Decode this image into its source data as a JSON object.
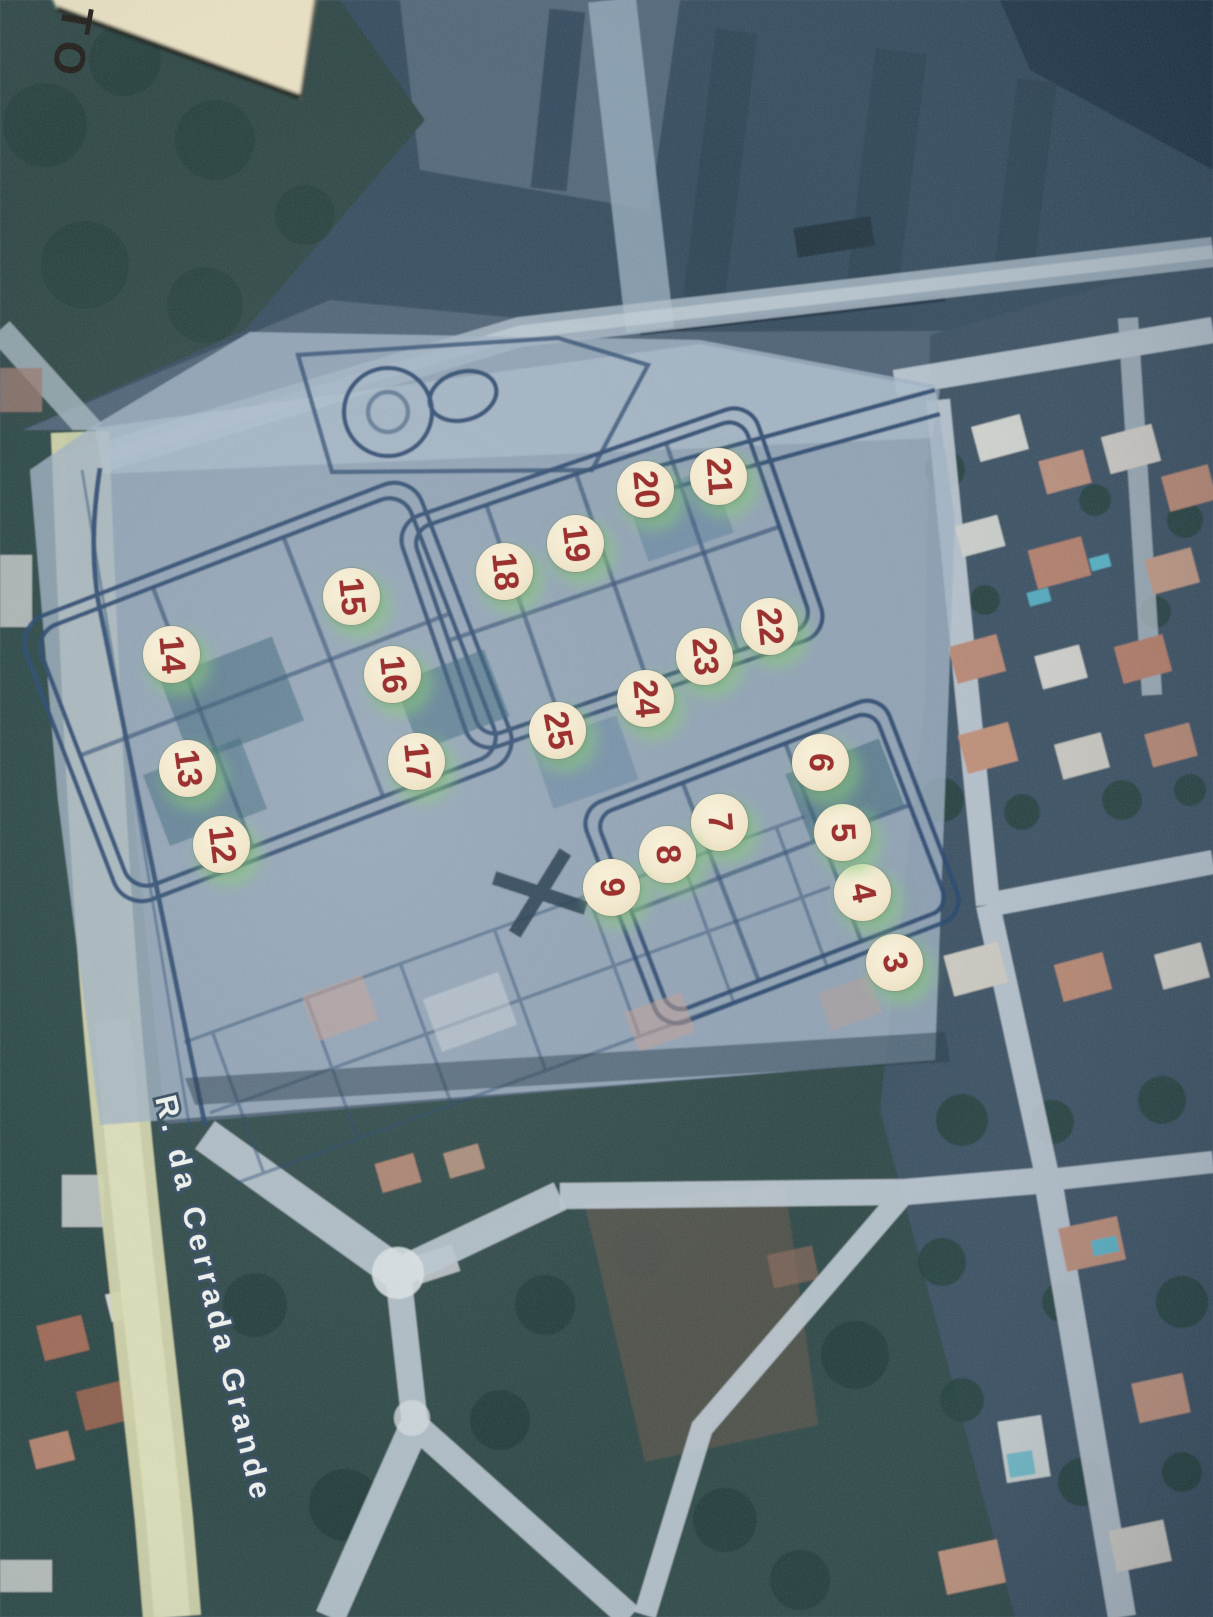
{
  "corner_label": {
    "text": "TO"
  },
  "street_label": {
    "text": "R. da Cerrada Grande"
  },
  "markers": [
    {
      "number": "3",
      "x": 895,
      "y": 963,
      "rot": 74
    },
    {
      "number": "4",
      "x": 863,
      "y": 893,
      "rot": 78
    },
    {
      "number": "5",
      "x": 843,
      "y": 833,
      "rot": 86
    },
    {
      "number": "6",
      "x": 821,
      "y": 763,
      "rot": 94
    },
    {
      "number": "7",
      "x": 720,
      "y": 823,
      "rot": 85
    },
    {
      "number": "8",
      "x": 668,
      "y": 855,
      "rot": 84
    },
    {
      "number": "9",
      "x": 612,
      "y": 888,
      "rot": 85
    },
    {
      "number": "12",
      "x": 222,
      "y": 845,
      "rot": 83
    },
    {
      "number": "13",
      "x": 188,
      "y": 769,
      "rot": 82
    },
    {
      "number": "14",
      "x": 172,
      "y": 655,
      "rot": 85
    },
    {
      "number": "15",
      "x": 352,
      "y": 597,
      "rot": 84
    },
    {
      "number": "16",
      "x": 393,
      "y": 675,
      "rot": 84
    },
    {
      "number": "17",
      "x": 417,
      "y": 762,
      "rot": 84
    },
    {
      "number": "18",
      "x": 505,
      "y": 572,
      "rot": 84
    },
    {
      "number": "19",
      "x": 576,
      "y": 544,
      "rot": 83
    },
    {
      "number": "20",
      "x": 646,
      "y": 490,
      "rot": 85
    },
    {
      "number": "21",
      "x": 719,
      "y": 477,
      "rot": 86
    },
    {
      "number": "22",
      "x": 770,
      "y": 627,
      "rot": 84
    },
    {
      "number": "23",
      "x": 705,
      "y": 657,
      "rot": 85
    },
    {
      "number": "24",
      "x": 646,
      "y": 699,
      "rot": 85
    },
    {
      "number": "25",
      "x": 558,
      "y": 731,
      "rot": 79
    }
  ],
  "colors": {
    "marker_fill": "#f2e8cf",
    "marker_number": "#9c3230",
    "marker_halo": "#a6d896",
    "street_text_fill": "#f3f6f0",
    "street_text_outline": "#33495f",
    "paper_fill": "#ece3c4",
    "paper_text": "#201c17",
    "plan_line": "#28476d",
    "road_yellow": "#d5d7ac"
  }
}
